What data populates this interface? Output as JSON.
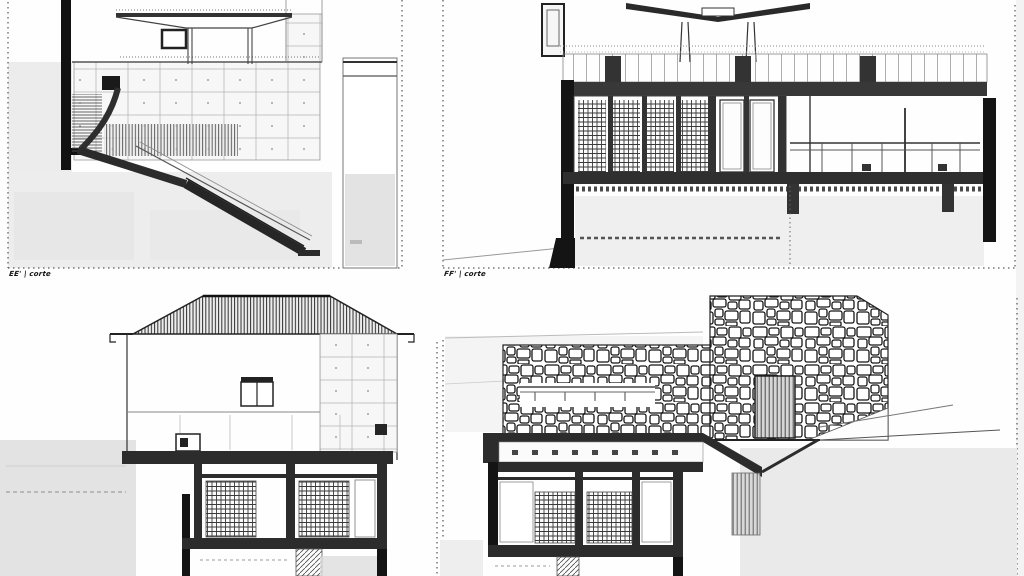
{
  "sheet": {
    "background": "#fefefe",
    "ink": "#1f1f1f",
    "dark_fill": "#2c2c2c",
    "ghost_gray": "#e8e8e8",
    "drawings": [
      {
        "id": "section-ee",
        "position": "top-left",
        "label": "EE' | corte"
      },
      {
        "id": "section-ff",
        "position": "top-right",
        "label": "FF' | corte"
      },
      {
        "id": "house-cross-section",
        "position": "bottom-left",
        "label": ""
      },
      {
        "id": "stone-wall-section",
        "position": "bottom-right",
        "label": ""
      }
    ]
  }
}
